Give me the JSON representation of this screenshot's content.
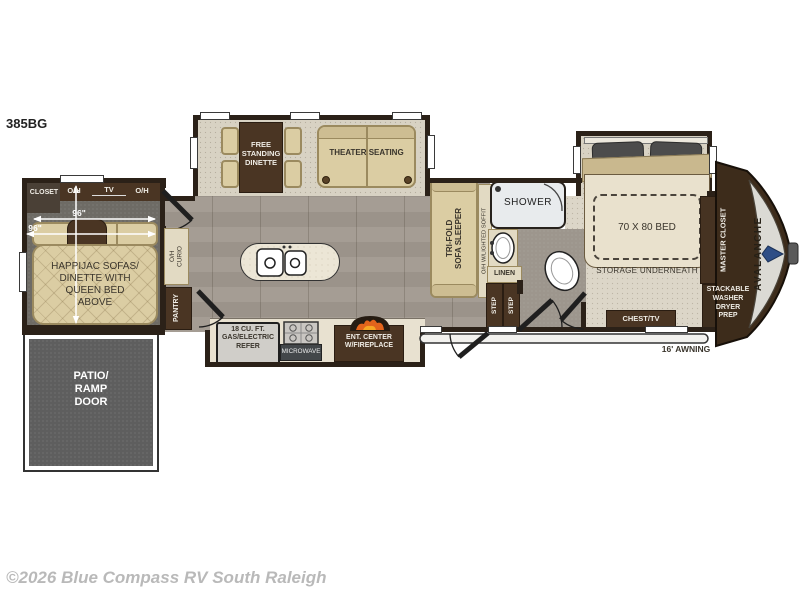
{
  "model": "385BG",
  "brand": "AVALANCHE",
  "copyright": "©2026 Blue Compass RV South Raleigh",
  "rear_room": {
    "closet": "CLOSET",
    "overhead_left": "O/H",
    "tv": "TV",
    "overhead_right": "O/H",
    "width_dim": "96\"",
    "width_dim_2": "96\"",
    "sofa": "HAPPIJAC SOFAS/\nDINETTE WITH\nQUEEN BED\nABOVE"
  },
  "patio": {
    "label": "PATIO/\nRAMP\nDOOR"
  },
  "main_slide": {
    "dinette": "FREE\nSTANDING\nDINETTE",
    "theater": "THEATER SEATING"
  },
  "kitchen": {
    "curio": "O/H\nCURIO",
    "pantry": "PANTRY",
    "refrigerator": "18 CU. FT.\nGAS/ELECTRIC\nREFER",
    "microwave": "MICROWAVE",
    "ent_center": "ENT. CENTER\nW/FIREPLACE"
  },
  "living": {
    "sofa": "TRI-FOLD\nSOFA SLEEPER",
    "soffit": "O/H W/LIGHTED SOFFIT"
  },
  "bath": {
    "shower": "SHOWER",
    "linen": "LINEN",
    "step_1": "STEP",
    "step_2": "STEP"
  },
  "bedroom": {
    "bed": "70 X 80 BED",
    "storage": "STORAGE UNDERNEATH",
    "chest": "CHEST/TV",
    "master_closet": "MASTER CLOSET",
    "washer_prep": "STACKABLE\nWASHER\nDRYER\nPREP"
  },
  "exterior": {
    "awning": "16' AWNING"
  }
}
